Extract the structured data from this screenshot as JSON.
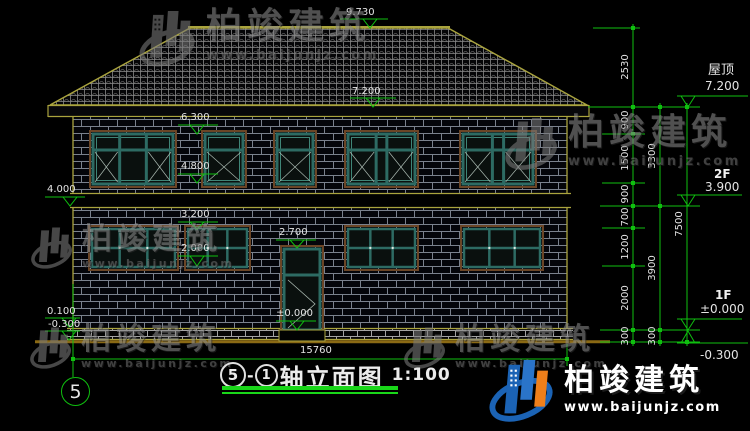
{
  "drawing": {
    "title": {
      "axis_start": "5",
      "separator": "-",
      "axis_end": "1",
      "name": "轴立面图",
      "scale": "1:100"
    },
    "axis_bubble": "5",
    "total_width": "15760",
    "facade_levels": {
      "ridge": "9.730",
      "eave": "7.200",
      "win2f_top": "6.300",
      "win2f_sill": "4.800",
      "left_belt": "4.000",
      "win1f_top": "3.200",
      "win1f_sill": "2.000",
      "door_top": "2.700",
      "door_floor": "±0.000",
      "plinth_left": "0.100",
      "ground_left": "-0.300"
    },
    "dim_chain_inner": [
      "2530",
      "900",
      "1500",
      "900",
      "700",
      "1200",
      "2000",
      "300"
    ],
    "dim_chain_mid": [
      "3300",
      "3900",
      "300"
    ],
    "dim_chain_outer": [
      "7500"
    ],
    "level_labels": [
      {
        "name": "屋顶",
        "value": "7.200"
      },
      {
        "name": "2F",
        "value": "3.900"
      },
      {
        "name": "1F",
        "value": "±0.000"
      },
      {
        "name": "",
        "value": "-0.300"
      }
    ]
  },
  "watermark": {
    "brand": "柏竣建筑",
    "url": "www.baijunjz.com"
  },
  "logo": {
    "brand": "柏竣建筑",
    "url": "www.baijunjz.com"
  },
  "colors": {
    "cad_green": "#0fbf0f",
    "outline_yellow": "#aaa43e",
    "ground_brown": "#8a6914",
    "frame_teal": "#2d6b63",
    "trim_brown": "#6b4526",
    "brand_blue": "#1b63b5",
    "brand_orange": "#ef7f1a",
    "mortar_gray": "#97a0ae"
  }
}
